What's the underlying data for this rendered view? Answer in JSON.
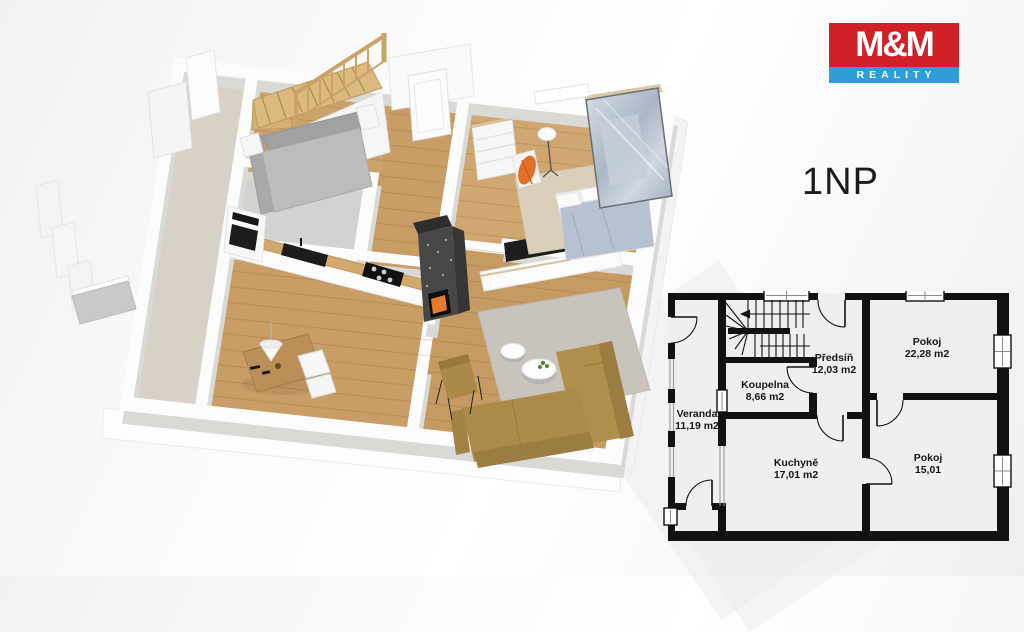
{
  "logo": {
    "brand": "M&M",
    "tagline": "REALITY",
    "brand_bg_color": "#cf2127",
    "tagline_bg_color": "#2f9ed8",
    "text_color": "#ffffff"
  },
  "floor_label": "1NP",
  "plan": {
    "rooms": [
      {
        "name": "Veranda",
        "area": "11,19 m2"
      },
      {
        "name": "Koupelna",
        "area": "8,66 m2"
      },
      {
        "name": "Předsíň",
        "area": "12,03 m2"
      },
      {
        "name": "Kuchyně",
        "area": "17,01 m2"
      },
      {
        "name": "Pokoj",
        "area": "22,28 m2"
      },
      {
        "name": "Pokoj",
        "area": "15,01"
      }
    ]
  },
  "render3d": {
    "description_colors": {
      "wood_floor": "#c89d66",
      "bedroom_floor": "#d0a771",
      "veranda_carpet": "#d8d1c6",
      "sofa": "#ac8a49",
      "stairs_wood": "#d4b075",
      "fire_accent": "#e67a2d",
      "duvet": "#b6c1d1",
      "orange_throw": "#e2702b"
    }
  }
}
